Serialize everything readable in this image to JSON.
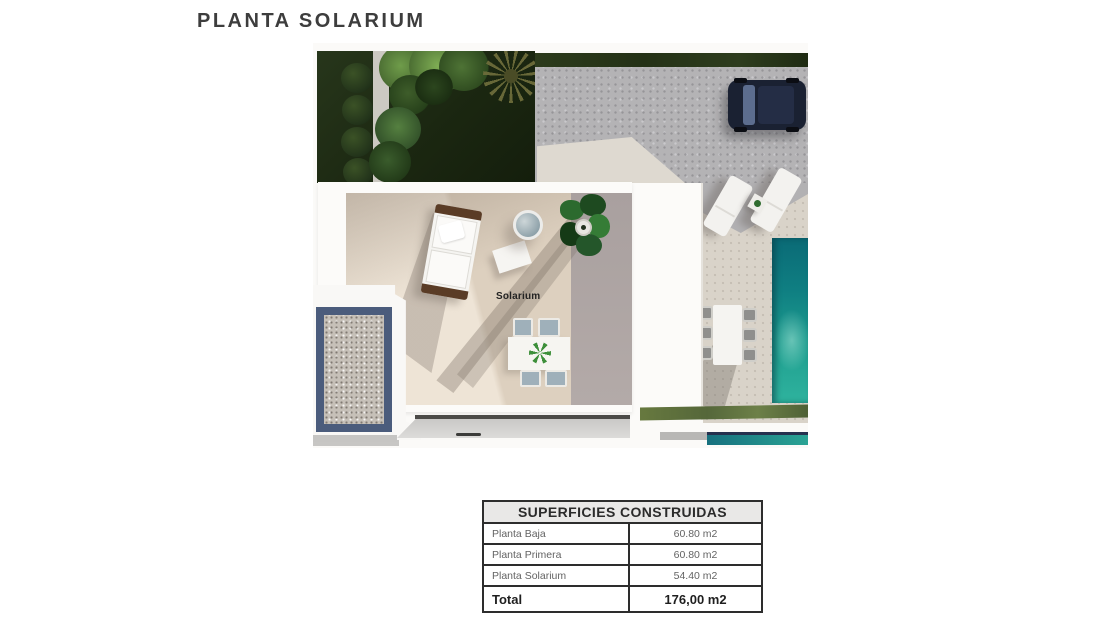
{
  "title": "PLANTA SOLARIUM",
  "plan": {
    "label_solarium": "Solarium",
    "colors": {
      "lawn_green": "#1b2711",
      "hedge_green": "#5f7240",
      "driveway_gray": "#b4b3b5",
      "terrace_beige": "#ddd0bf",
      "pool_teal": "#17948c",
      "roof_border_blue": "#4b5c7c",
      "car_navy": "#1a2132"
    }
  },
  "table": {
    "header": "SUPERFICIES CONSTRUIDAS",
    "rows": [
      {
        "label": "Planta Baja",
        "value": "60.80 m2"
      },
      {
        "label": "Planta Primera",
        "value": "60.80 m2"
      },
      {
        "label": "Planta Solarium",
        "value": "54.40 m2"
      }
    ],
    "total": {
      "label": "Total",
      "value": "176,00 m2"
    }
  }
}
